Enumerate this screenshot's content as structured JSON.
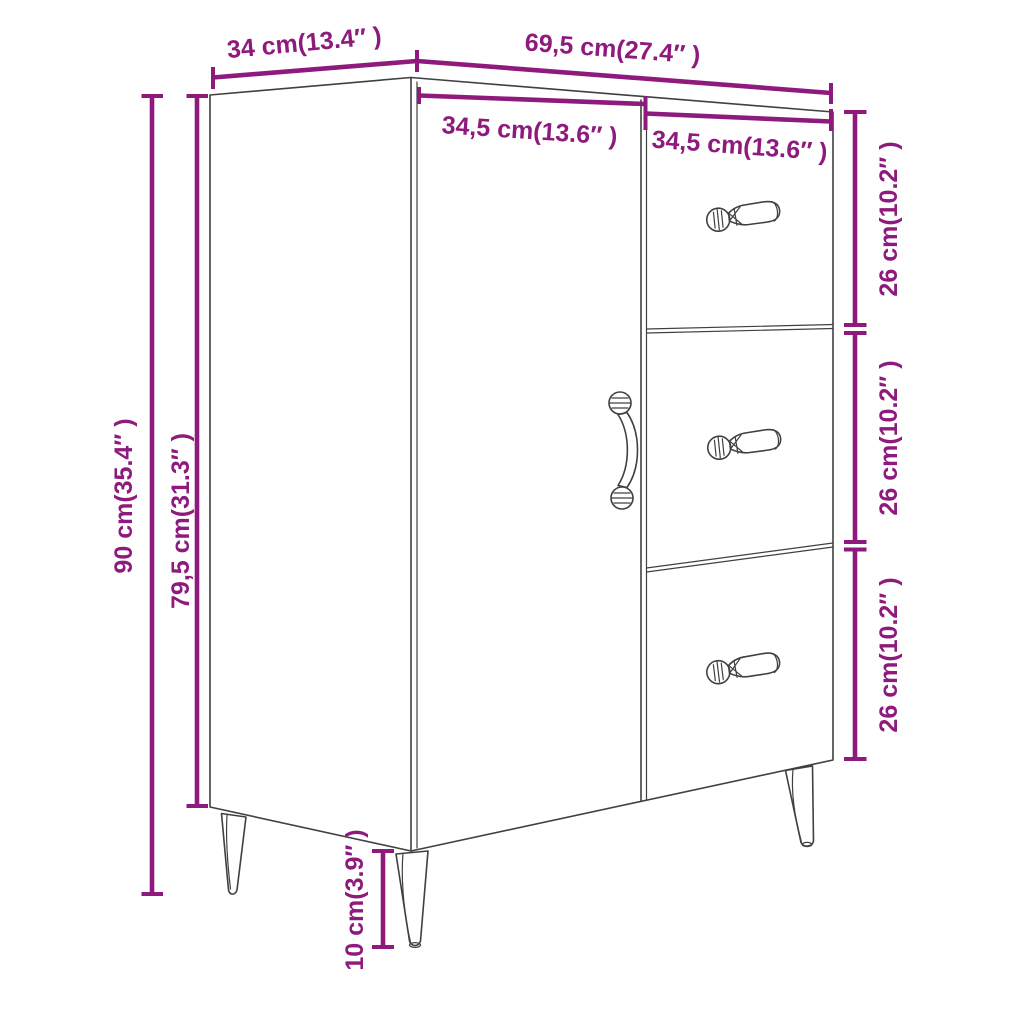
{
  "colors": {
    "dimension_accent": "#8d1a7c",
    "line_art": "#404040",
    "background": "#ffffff"
  },
  "dimensions": {
    "depth": {
      "label": "34 cm(13.4″ )",
      "cm": "34",
      "inches": "13.4"
    },
    "width": {
      "label": "69,5 cm(27.4″ )",
      "cm": "69,5",
      "inches": "27.4"
    },
    "door_width": {
      "label": "34,5 cm(13.6″ )",
      "cm": "34,5",
      "inches": "13.6"
    },
    "drawers_width": {
      "label": "34,5 cm(13.6″ )",
      "cm": "34,5",
      "inches": "13.6"
    },
    "total_height": {
      "label": "90 cm(35.4″ )",
      "cm": "90",
      "inches": "35.4"
    },
    "body_height": {
      "label": "79,5 cm(31.3″ )",
      "cm": "79,5",
      "inches": "31.3"
    },
    "top_drawer_height": {
      "label": "26 cm(10.2″ )",
      "cm": "26",
      "inches": "10.2"
    },
    "middle_drawer_height": {
      "label": "26 cm(10.2″ )",
      "cm": "26",
      "inches": "10.2"
    },
    "bottom_drawer_height": {
      "label": "26 cm(10.2″ )",
      "cm": "26",
      "inches": "10.2"
    },
    "leg_height": {
      "label": "10 cm(3.9″ )",
      "cm": "10",
      "inches": "3.9"
    }
  }
}
